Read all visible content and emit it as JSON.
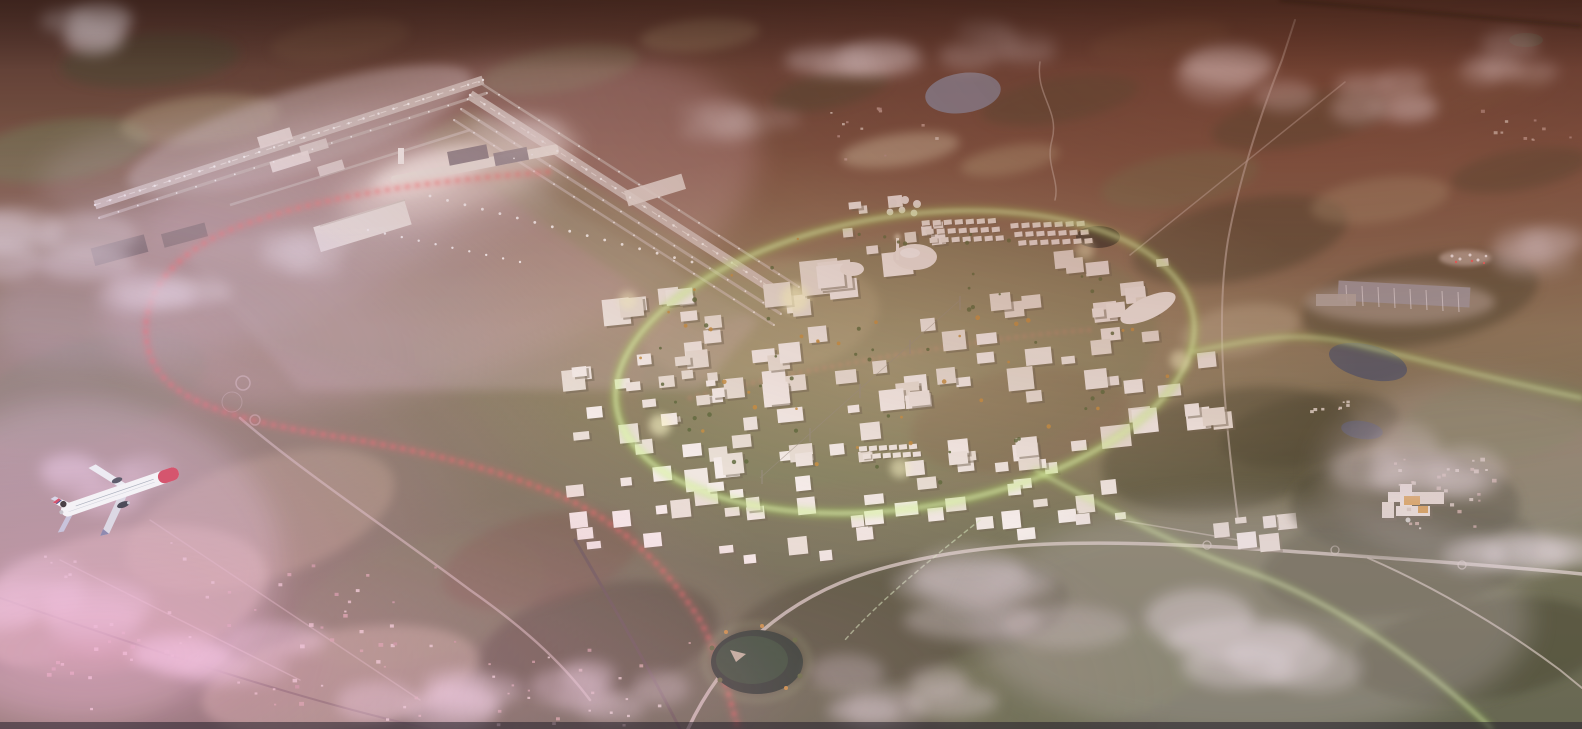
{
  "scene": {
    "type": "aerial-architectural-rendering",
    "description": "Aerial dusk rendering of an airport-city masterplan: an airport with two runways and a glowing terminal at the upper left, a white massing-model city district encircled by a luminous green loop at center, a red dotted rail line curving around the airfield, green light trails running east, a hospital campus and logistics sheds to the right, scattered clouds and pink haze, and a white Norwegian airliner with a red nose flying at the lower left.",
    "palette": {
      "ground_top": "#472c24",
      "ground_upper": "#76523e",
      "ground_mid": "#8a7b5c",
      "ground_lower": "#6f7052",
      "ground_bottom": "#5f654c",
      "pavement": "#b7a39f",
      "runway": "#cfc2bd",
      "runway_line": "#f2ece8",
      "building": "#f3eee6",
      "building_alt1": "#ece6da",
      "building_alt2": "#f8f4ee",
      "building_shadow": "#6f6752",
      "red_glow": "#ff5f5f",
      "green_glow": "#b4f55f",
      "green_core": "#eaffc0",
      "cloud": "#e6dee2",
      "haze_pink": "#f2aad6",
      "haze_lavender": "#c9a8d4",
      "warm_top_right": "#7a3a22",
      "plane_white": "#f4f2f6",
      "plane_red": "#d5556e",
      "plane_wing": "#dcd8e4",
      "plane_dark": "#4e4c5a",
      "water_blue": "#7e8ea6",
      "water_dark": "#24392a",
      "pond_dark": "#20221b",
      "pond_right": "#4a5668",
      "forest": "#3f4229",
      "field": "#b3a67f",
      "green_field": "#6c7850",
      "brown": "#6b4e38",
      "pale": "#cbbfa0",
      "tree_green": "#5a6b3a",
      "tree_orange": "#c8923e",
      "village_tones": [
        "#d8ccc0",
        "#c4a69a",
        "#b89890",
        "#e0d8cc"
      ],
      "light_dot": "#ffffff"
    }
  },
  "terrain": {
    "patches": [
      [
        150,
        60,
        90,
        26,
        -5,
        "forest",
        0.5
      ],
      [
        340,
        40,
        70,
        20,
        -8,
        "brown",
        0.45
      ],
      [
        560,
        70,
        80,
        22,
        -10,
        "green_field",
        0.4
      ],
      [
        700,
        35,
        60,
        16,
        -5,
        "field",
        0.35
      ],
      [
        830,
        90,
        60,
        18,
        -12,
        "forest",
        0.55
      ],
      [
        1060,
        100,
        80,
        22,
        -10,
        "forest",
        0.5
      ],
      [
        1160,
        40,
        70,
        18,
        -8,
        "brown",
        0.5
      ],
      [
        1300,
        120,
        90,
        26,
        -10,
        "forest",
        0.55
      ],
      [
        1470,
        90,
        80,
        22,
        -8,
        "brown",
        0.5
      ],
      [
        1520,
        170,
        70,
        20,
        -10,
        "forest",
        0.5
      ],
      [
        900,
        150,
        60,
        16,
        -8,
        "pale",
        0.6
      ],
      [
        1010,
        160,
        50,
        14,
        -10,
        "field",
        0.5
      ],
      [
        60,
        150,
        90,
        30,
        -8,
        "green_field",
        0.5
      ],
      [
        200,
        120,
        80,
        24,
        -6,
        "field",
        0.4
      ],
      [
        1240,
        240,
        110,
        40,
        -12,
        "forest",
        0.6
      ],
      [
        1420,
        300,
        120,
        45,
        -10,
        "forest",
        0.55
      ],
      [
        1500,
        420,
        100,
        40,
        -8,
        "green_field",
        0.5
      ],
      [
        1310,
        430,
        90,
        35,
        -10,
        "forest",
        0.5
      ],
      [
        1180,
        180,
        80,
        26,
        -10,
        "green_field",
        0.45
      ],
      [
        1380,
        200,
        70,
        22,
        -8,
        "field",
        0.4
      ],
      [
        900,
        360,
        260,
        120,
        -9,
        "green_field",
        0.45
      ],
      [
        760,
        320,
        120,
        60,
        -9,
        "field",
        0.35
      ],
      [
        1020,
        420,
        110,
        50,
        -9,
        "brown",
        0.3
      ],
      [
        90,
        390,
        120,
        50,
        -15,
        "green_field",
        0.5
      ],
      [
        260,
        520,
        140,
        60,
        -18,
        "field",
        0.45
      ],
      [
        120,
        600,
        150,
        70,
        -12,
        "pale",
        0.5
      ],
      [
        420,
        600,
        130,
        60,
        -15,
        "green_field",
        0.5
      ],
      [
        600,
        640,
        120,
        55,
        -12,
        "forest",
        0.55
      ],
      [
        900,
        620,
        170,
        60,
        -8,
        "forest",
        0.5
      ],
      [
        1060,
        680,
        150,
        50,
        -8,
        "green_field",
        0.45
      ],
      [
        540,
        560,
        100,
        45,
        -14,
        "brown",
        0.4
      ],
      [
        340,
        680,
        140,
        50,
        -10,
        "pale",
        0.45
      ],
      [
        60,
        700,
        120,
        40,
        -8,
        "green_field",
        0.5
      ],
      [
        1480,
        650,
        130,
        50,
        -8,
        "forest",
        0.5
      ],
      [
        1240,
        330,
        60,
        25,
        -10,
        "pale",
        0.4
      ],
      [
        1230,
        450,
        130,
        60,
        -10,
        "forest",
        0.55
      ],
      [
        1400,
        560,
        140,
        55,
        -8,
        "forest",
        0.5
      ]
    ]
  },
  "airport": {
    "runway_strokes": [
      [
        95,
        205,
        483,
        80,
        9
      ],
      [
        470,
        95,
        790,
        300,
        10
      ]
    ],
    "taxi_strokes": [
      [
        461,
        109,
        781,
        314,
        3
      ],
      [
        454,
        120,
        774,
        325,
        2.5
      ],
      [
        479,
        82,
        799,
        287,
        2.5
      ],
      [
        99,
        218,
        487,
        93,
        3
      ],
      [
        230,
        205,
        470,
        130,
        2.5
      ]
    ],
    "dot_lines": [
      [
        95,
        205,
        483,
        80,
        26,
        1.2
      ],
      [
        470,
        95,
        790,
        300,
        22,
        1.2
      ],
      [
        461,
        109,
        781,
        314,
        18,
        0.9
      ],
      [
        454,
        120,
        774,
        325,
        16,
        0.9
      ],
      [
        479,
        82,
        799,
        287,
        16,
        0.9
      ],
      [
        99,
        218,
        487,
        93,
        20,
        0.9
      ],
      [
        430,
        196,
        692,
        262,
        15,
        1.4
      ],
      [
        368,
        230,
        520,
        262,
        9,
        1.2
      ]
    ]
  },
  "city": {
    "ring": {
      "cx": 905,
      "cy": 362,
      "rx": 292,
      "ry": 146,
      "rot": -9
    },
    "clusters": [
      [
        560,
        320,
        120,
        110,
        13,
        10,
        24
      ],
      [
        688,
        272,
        150,
        110,
        15,
        10,
        24
      ],
      [
        606,
        396,
        150,
        100,
        12,
        12,
        28
      ],
      [
        762,
        352,
        170,
        130,
        16,
        10,
        26
      ],
      [
        898,
        296,
        180,
        120,
        15,
        12,
        28
      ],
      [
        1040,
        268,
        140,
        100,
        12,
        10,
        24
      ],
      [
        948,
        388,
        180,
        120,
        13,
        12,
        30
      ],
      [
        1088,
        356,
        140,
        110,
        10,
        12,
        26
      ],
      [
        826,
        438,
        160,
        100,
        12,
        10,
        24
      ],
      [
        976,
        466,
        150,
        90,
        10,
        10,
        22
      ],
      [
        700,
        462,
        120,
        90,
        9,
        10,
        20
      ],
      [
        556,
        448,
        110,
        80,
        8,
        10,
        18
      ],
      [
        856,
        196,
        150,
        60,
        9,
        8,
        16
      ],
      [
        768,
        240,
        200,
        55,
        6,
        24,
        40
      ],
      [
        598,
        248,
        120,
        64,
        5,
        18,
        30
      ],
      [
        1186,
        552,
        95,
        42,
        6,
        10,
        20
      ],
      [
        636,
        330,
        90,
        60,
        8,
        8,
        16
      ]
    ],
    "row_grids": [
      {
        "x": 938,
        "y": 224,
        "rows": 3,
        "cols": 7,
        "cw": 8,
        "ch": 5,
        "dx": 11,
        "dy": 0.8,
        "rdx": 3,
        "rdy": 9
      },
      {
        "x": 1026,
        "y": 236,
        "rows": 3,
        "cols": 7,
        "cw": 8,
        "ch": 5,
        "dx": 11,
        "dy": 0.8,
        "rdx": 3,
        "rdy": 9
      },
      {
        "x": 852,
        "y": 442,
        "rows": 2,
        "cols": 6,
        "cw": 8,
        "ch": 5,
        "dx": 10,
        "dy": 0.6,
        "rdx": 3,
        "rdy": 8
      }
    ],
    "tree_count": 80
  },
  "villages": [
    [
      40,
      540,
      420,
      180,
      70,
      2,
      5
    ],
    [
      1390,
      455,
      110,
      80,
      28,
      2,
      5
    ],
    [
      470,
      640,
      220,
      90,
      24,
      2,
      4
    ],
    [
      820,
      100,
      120,
      60,
      12,
      2,
      4
    ],
    [
      1480,
      100,
      90,
      50,
      10,
      2,
      4
    ],
    [
      1310,
      396,
      46,
      18,
      8,
      2,
      4
    ]
  ],
  "clouds": [
    [
      95,
      30,
      60,
      0.5
    ],
    [
      45,
      250,
      85,
      0.5
    ],
    [
      175,
      298,
      65,
      0.4
    ],
    [
      320,
      255,
      55,
      0.3
    ],
    [
      865,
      55,
      70,
      0.45
    ],
    [
      1000,
      42,
      55,
      0.35
    ],
    [
      1235,
      75,
      85,
      0.5
    ],
    [
      1390,
      98,
      65,
      0.45
    ],
    [
      1500,
      58,
      55,
      0.4
    ],
    [
      110,
      480,
      75,
      0.45
    ],
    [
      55,
      600,
      105,
      0.6
    ],
    [
      225,
      655,
      85,
      0.5
    ],
    [
      425,
      700,
      85,
      0.5
    ],
    [
      620,
      692,
      75,
      0.4
    ],
    [
      1045,
      600,
      120,
      0.45
    ],
    [
      1255,
      645,
      115,
      0.5
    ],
    [
      1425,
      462,
      95,
      0.45
    ],
    [
      1530,
      565,
      85,
      0.45
    ],
    [
      895,
      692,
      85,
      0.4
    ],
    [
      1560,
      250,
      60,
      0.35
    ],
    [
      730,
      120,
      60,
      0.3
    ],
    [
      540,
      140,
      55,
      0.25
    ]
  ],
  "airplane": {
    "livery": "white fuselage, red nose cone, tail-fin portrait with red tip stripe, grey swept wings, two dark engines",
    "x": 120,
    "y": 492,
    "heading_deg": -19
  }
}
